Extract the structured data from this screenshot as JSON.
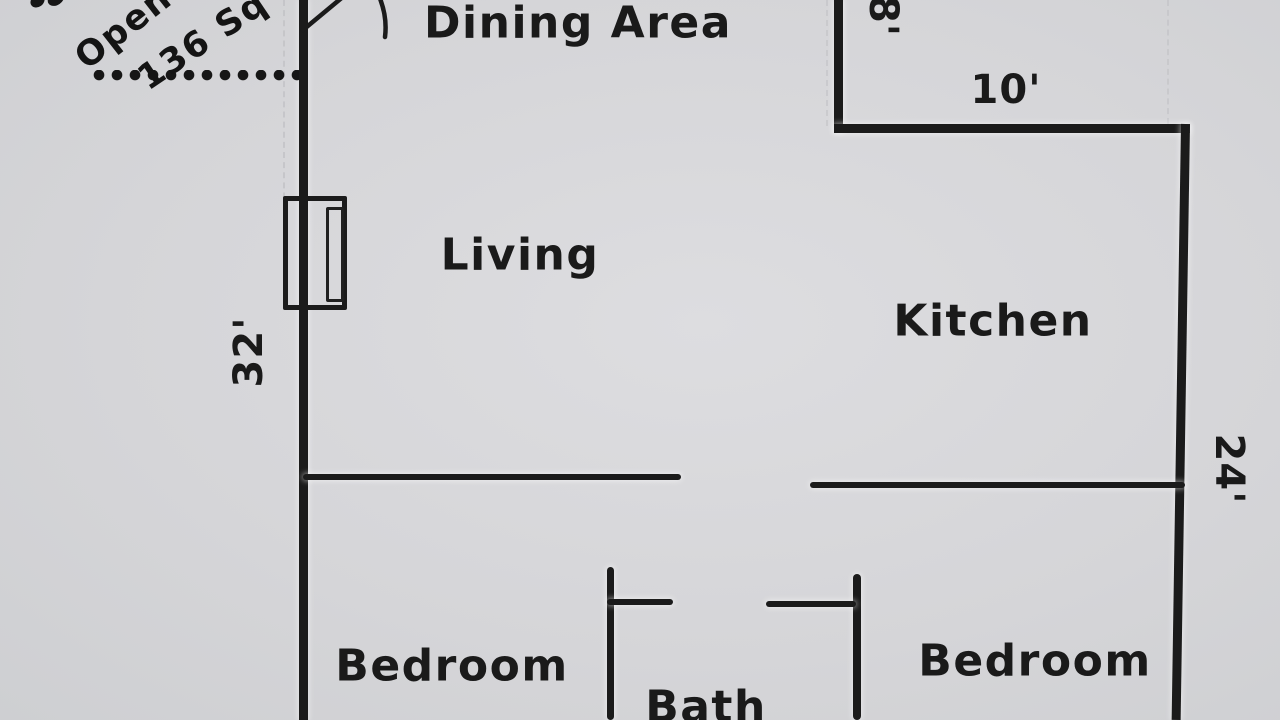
{
  "colors": {
    "paper": "#d5d5d8",
    "ink": "#1b1b1b"
  },
  "rooms": {
    "dining": {
      "label": "Dining Area"
    },
    "living": {
      "label": "Living"
    },
    "kitchen": {
      "label": "Kitchen"
    },
    "bedroom_left": {
      "label": "Bedroom"
    },
    "bath": {
      "label": "Bath"
    },
    "bedroom_right": {
      "label": "Bedroom"
    }
  },
  "dimensions": {
    "left_wall_height": "32'",
    "right_wall_height": "24'",
    "notch_width": "10'",
    "notch_depth": "8'"
  },
  "porch_annotation": {
    "word": "Open",
    "area": "136 Sq"
  }
}
